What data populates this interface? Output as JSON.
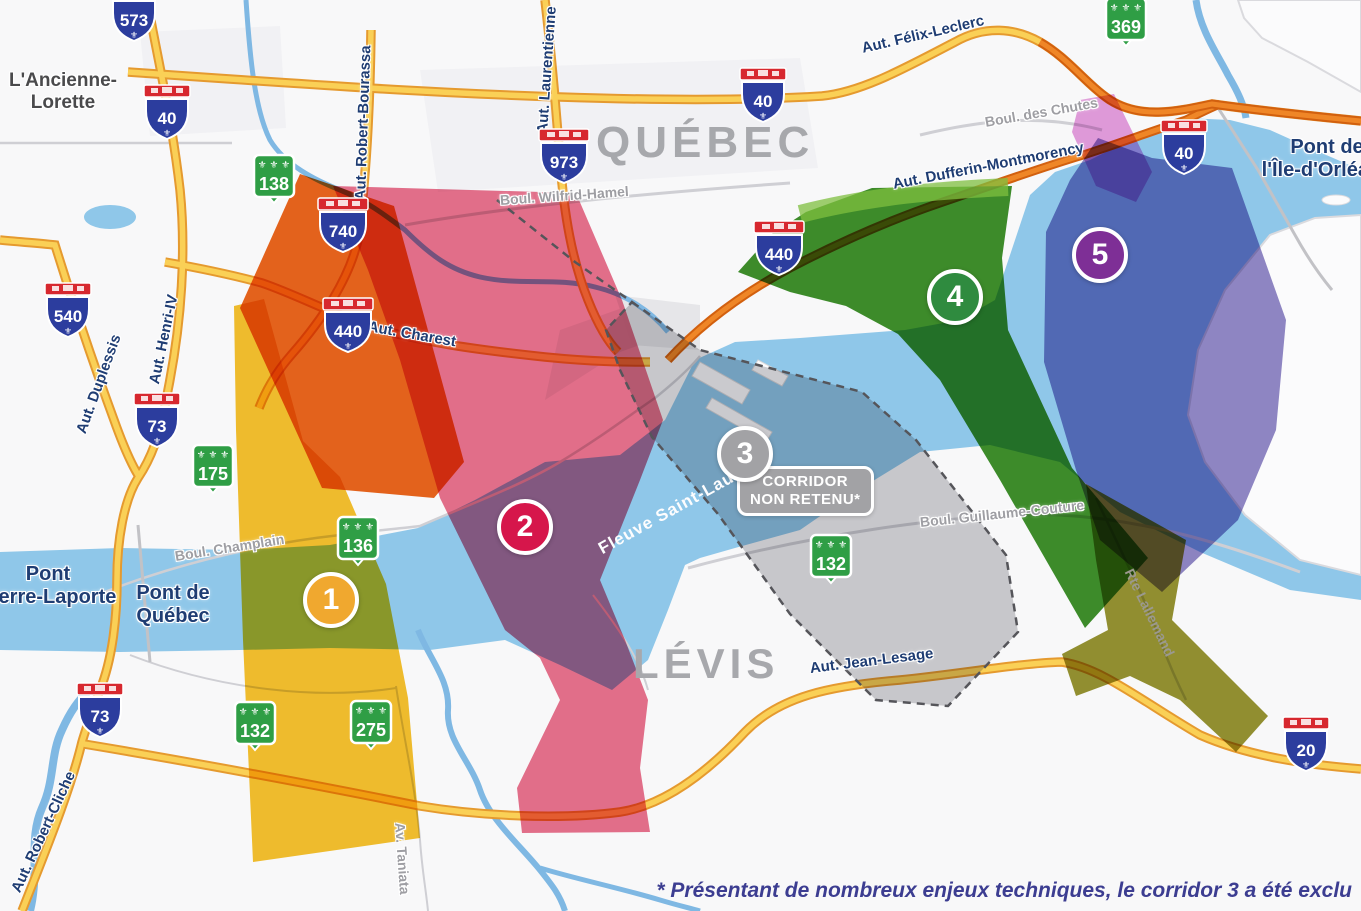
{
  "map": {
    "city_labels": {
      "quebec": "QUÉBEC",
      "levis": "LÉVIS",
      "ancienne_lorette": {
        "line1": "L'Ancienne-",
        "line2": "Lorette"
      }
    },
    "bridge_labels": {
      "pierre_laporte": {
        "line1": "Pont",
        "line2": "Pierre-Laporte"
      },
      "pont_de_quebec": {
        "line1": "Pont de",
        "line2": "Québec"
      },
      "ile_dorleans": {
        "line1": "Pont de",
        "line2": "l'Île-d'Orléans"
      }
    },
    "water_labels": {
      "fleuve": "Fleuve Saint-Laurent"
    },
    "road_labels": {
      "felix_leclerc": "Aut. Félix-Leclerc",
      "robert_bourassa": "Aut. Robert-Bourassa",
      "laurentienne": "Aut. Laurentienne",
      "wilfrid_hamel": "Boul. Wilfrid-Hamel",
      "des_chutes": "Boul. des Chutes",
      "dufferin": "Aut. Dufferin-Montmorency",
      "charest": "Aut. Charest",
      "henri_iv": "Aut. Henri-IV",
      "duplessis": "Aut. Duplessis",
      "champlain": "Boul. Champlain",
      "guillaume_couture": "Boul. Guillaume-Couture",
      "jean_lesage": "Aut. Jean-Lesage",
      "robert_cliche": "Aut. Robert-Cliche",
      "taniata": "Av. Taniata",
      "lallemand": "Rte Lallemand"
    },
    "autoroute_shields": {
      "a573": "573",
      "a40_west": "40",
      "a540": "540",
      "a73_north": "73",
      "a73_south": "73",
      "a740": "740",
      "a440_west": "440",
      "a973": "973",
      "a40_center": "40",
      "a440_east": "440",
      "a40_east": "40",
      "a20": "20"
    },
    "route_markers": {
      "r138": "138",
      "r175": "175",
      "r136": "136",
      "r132_west": "132",
      "r275": "275",
      "r132_east": "132",
      "r369": "369"
    },
    "corridors": {
      "c1": {
        "number": "1",
        "badge_color": "#F0A82F"
      },
      "c2": {
        "number": "2",
        "badge_color": "#D6164B"
      },
      "c3": {
        "number": "3",
        "badge_color": "#A2A2A5",
        "note": {
          "line1": "CORRIDOR",
          "line2": "NON RETENU*"
        }
      },
      "c4": {
        "number": "4",
        "badge_color": "#2F8B3F"
      },
      "c5": {
        "number": "5",
        "badge_color": "#7E2F96"
      }
    },
    "colors": {
      "corridor1_yellow": "#F5C12E",
      "corridor1_orange": "#EA651C",
      "corridor2_pink": "#E8718C",
      "corridor3_gray": "#C9C9CC",
      "corridor4_green": "#3E8F2B",
      "corridor4_highway_stripe": "#7FBF3F",
      "corridor5_purple": "#9087C5",
      "corridor5_magenta": "#E08CD8",
      "corridor45_south_olive": "#8F8C26",
      "water_blue": "#8FC7E9",
      "highway_yellow": "#FAD056",
      "highway_orange": "#EF8627"
    },
    "footnote": "* Présentant de nombreux enjeux techniques, le corridor 3 a été exclu"
  }
}
